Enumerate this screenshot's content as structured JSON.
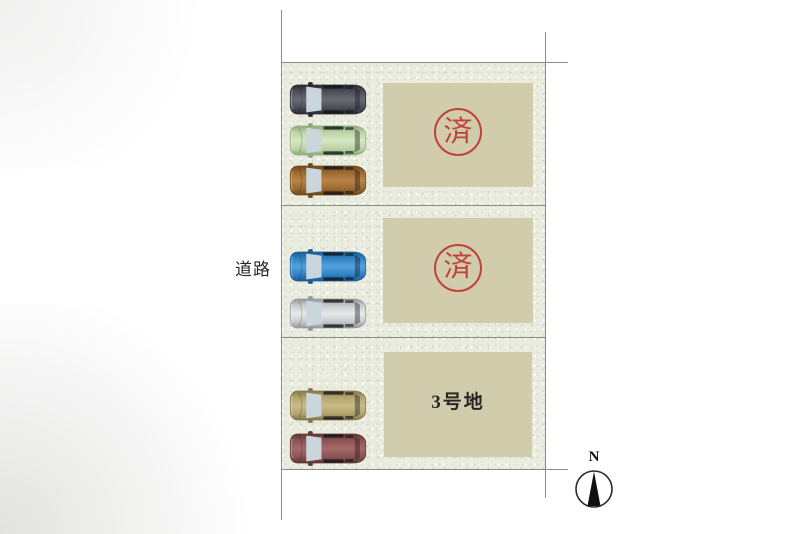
{
  "plan": {
    "road_label": "道路",
    "compass_label": "N",
    "colors": {
      "ground": "#eaece0",
      "pad": "#d1ccac",
      "boundary_line": "#8b8d83",
      "stamp_red": "#c2423a",
      "label_text": "#2a2623"
    },
    "lots": [
      {
        "id": "lot-1",
        "status": "sold",
        "stamp": "済",
        "label": "",
        "pad": {
          "x": 383,
          "y": 83,
          "w": 150,
          "h": 104
        }
      },
      {
        "id": "lot-2",
        "status": "sold",
        "stamp": "済",
        "label": "",
        "pad": {
          "x": 383,
          "y": 218,
          "w": 150,
          "h": 105
        }
      },
      {
        "id": "lot-3",
        "status": "available",
        "stamp": "",
        "label": "3号地",
        "pad": {
          "x": 384,
          "y": 352,
          "w": 148,
          "h": 105
        }
      }
    ],
    "cars": [
      {
        "name": "dark-gray-car",
        "x": 288,
        "y": 81,
        "body": "#4e4e58",
        "dark": "#2a2a32",
        "light": "#6a6a76"
      },
      {
        "name": "green-car",
        "x": 288,
        "y": 122,
        "body": "#bcd4a6",
        "dark": "#8cab78",
        "light": "#d6e6c4"
      },
      {
        "name": "brown-car",
        "x": 288,
        "y": 162,
        "body": "#9c6a31",
        "dark": "#6d471e",
        "light": "#b78347"
      },
      {
        "name": "blue-car",
        "x": 288,
        "y": 248,
        "body": "#2e82c5",
        "dark": "#1a5b95",
        "light": "#55a1dc"
      },
      {
        "name": "silver-car",
        "x": 288,
        "y": 295,
        "body": "#c8cbcc",
        "dark": "#94989a",
        "light": "#e8eaea"
      },
      {
        "name": "khaki-car",
        "x": 288,
        "y": 387,
        "body": "#b3a36f",
        "dark": "#85764b",
        "light": "#cabb87"
      },
      {
        "name": "maroon-car",
        "x": 288,
        "y": 430,
        "body": "#8c5454",
        "dark": "#5e3636",
        "light": "#a66868"
      }
    ]
  }
}
